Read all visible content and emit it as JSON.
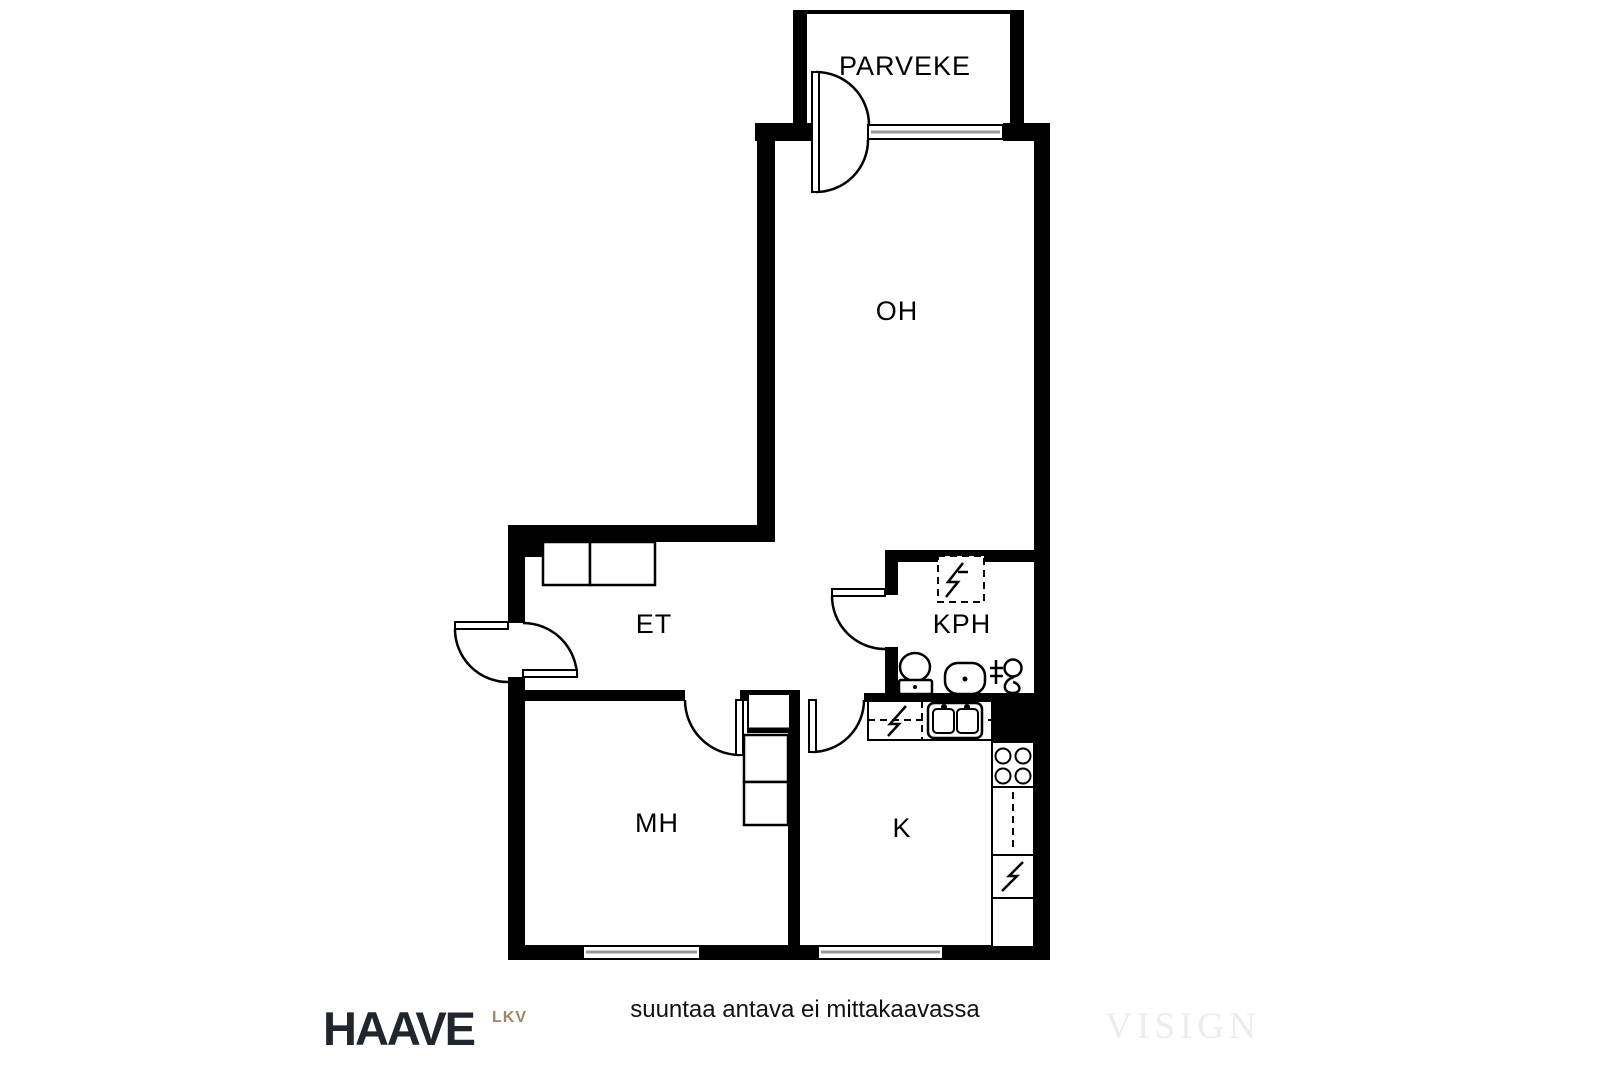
{
  "rooms": {
    "balcony": "PARVEKE",
    "living": "OH",
    "hall": "ET",
    "bath": "KPH",
    "bed": "MH",
    "kitchen": "K"
  },
  "footer": {
    "brand": "HAAVE",
    "brand_suffix": "LKV",
    "disclaimer": "suuntaa antava ei mittakaavassa",
    "watermark": "VISIGN"
  },
  "colors": {
    "walls": "#000000",
    "background": "#ffffff",
    "window_glass": "#999999",
    "brand_text": "#20262d",
    "brand_suffix_text": "#a0876a",
    "watermark_text": "#edecea"
  },
  "icons": [
    "toilet-icon",
    "washbasin-icon",
    "shower-mixer-icon",
    "appliance-reservation-icon",
    "kitchen-sink-icon",
    "stove-icon",
    "refrigerator-icon",
    "wardrobe-icon",
    "door-swing-icon",
    "window-icon"
  ]
}
